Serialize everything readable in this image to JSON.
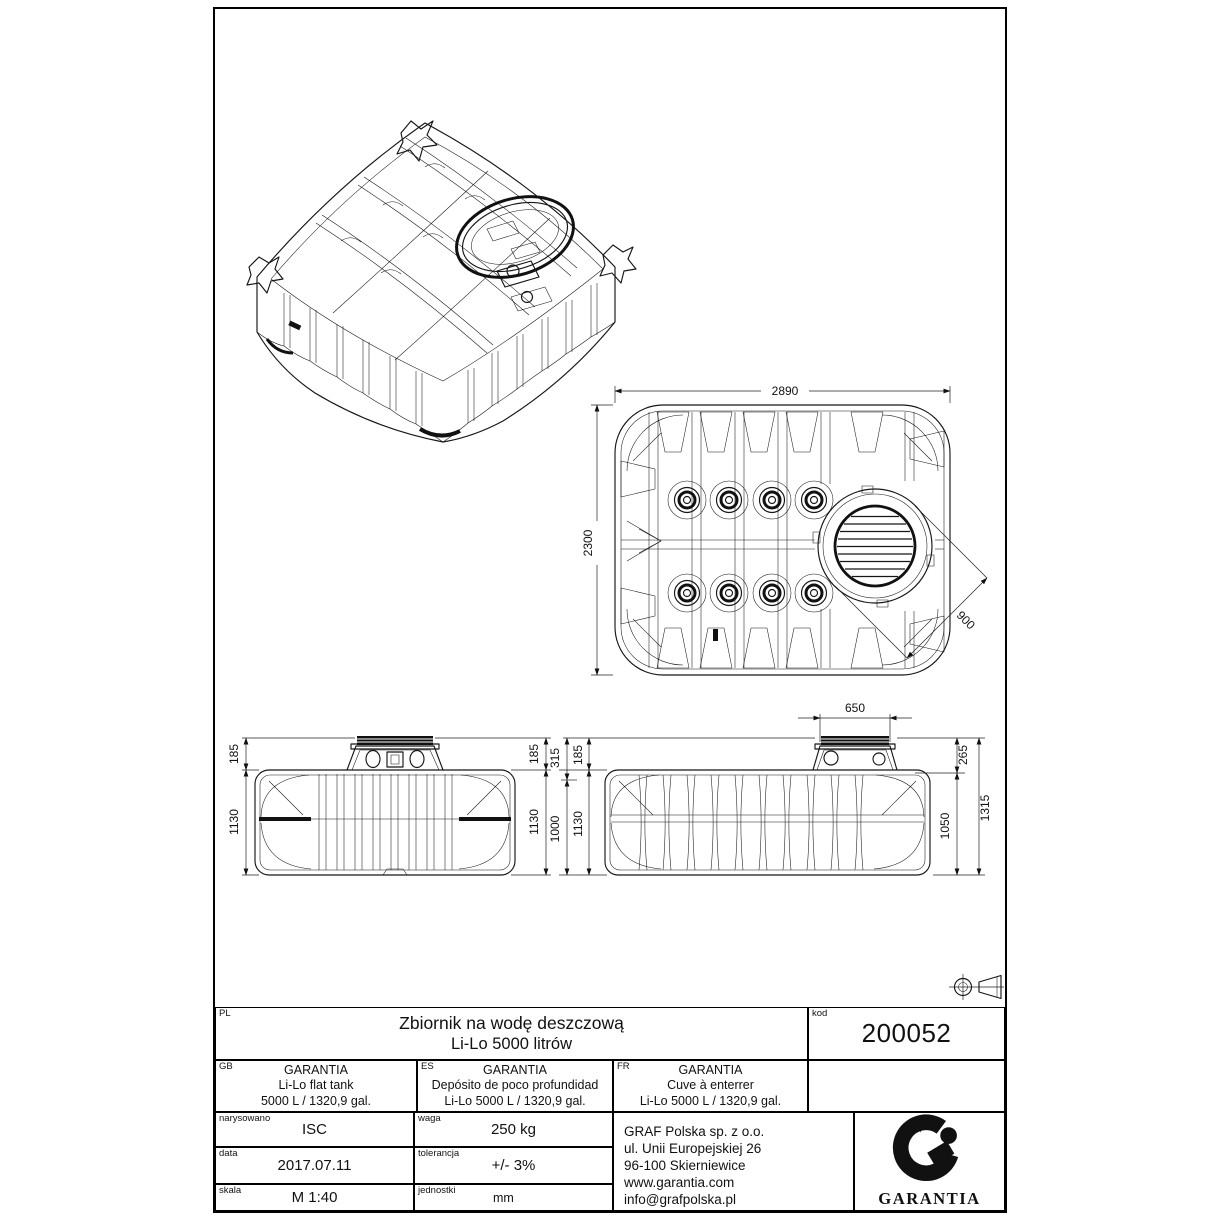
{
  "sheet": {
    "views": {
      "top": {
        "dim_width": "2890",
        "dim_depth": "2300",
        "dim_manhole": "900"
      },
      "end": {
        "dim_cover_l": "185",
        "dim_body_l": "1130",
        "dim_cover_r": "185",
        "dim_body_r": "1130"
      },
      "side": {
        "dim_neck": "650",
        "dim_315": "315",
        "dim_185": "185",
        "dim_1000": "1000",
        "dim_1130": "1130",
        "dim_265": "265",
        "dim_1050": "1050",
        "dim_1315": "1315"
      }
    },
    "title_block": {
      "pl": {
        "lang": "PL",
        "line1": "Zbiornik na wodę deszczową",
        "line2": "Li-Lo 5000 litrów"
      },
      "kod": {
        "label": "kod",
        "value": "200052"
      },
      "gb": {
        "lang": "GB",
        "line1": "GARANTIA",
        "line2": "Li-Lo flat tank",
        "line3": "5000 L / 1320,9 gal."
      },
      "es": {
        "lang": "ES",
        "line1": "GARANTIA",
        "line2": "Depósito de poco profundidad",
        "line3": "Li-Lo 5000 L / 1320,9 gal."
      },
      "fr": {
        "lang": "FR",
        "line1": "GARANTIA",
        "line2": "Cuve à enterrer",
        "line3": "Li-Lo  5000 L / 1320,9 gal."
      },
      "fields": {
        "narysowano": {
          "label": "narysowano",
          "value": "ISC"
        },
        "waga": {
          "label": "waga",
          "value": "250 kg"
        },
        "data": {
          "label": "data",
          "value": "2017.07.11"
        },
        "tolerancja": {
          "label": "tolerancja",
          "value": "+/- 3%"
        },
        "skala": {
          "label": "skala",
          "value": "M 1:40"
        },
        "jednostki": {
          "label": "jednostki",
          "value": "mm"
        }
      },
      "address": [
        "GRAF Polska sp. z o.o.",
        "ul. Unii Europejskiej 26",
        "96-100 Skierniewice",
        "www.garantia.com",
        "info@grafpolska.pl"
      ],
      "logo_text": "GARANTIA"
    }
  }
}
